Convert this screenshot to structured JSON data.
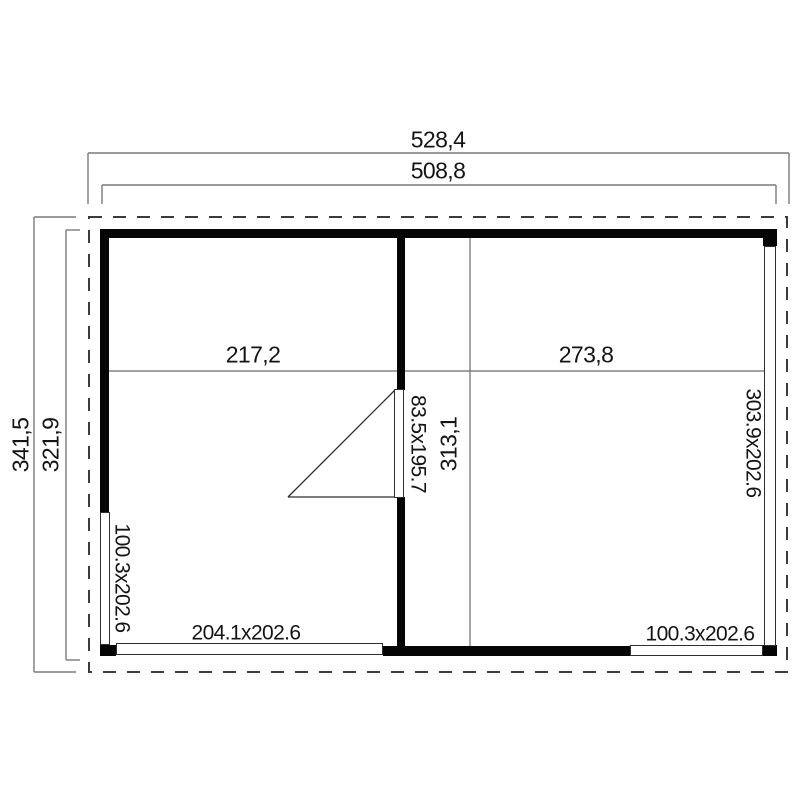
{
  "diagram": {
    "type": "floor-plan",
    "colors": {
      "background": "#ffffff",
      "wall": "#050505",
      "dimension_line": "#7a7a7a",
      "interior_line": "#6b6b6b",
      "roof_outline_dashed": "#3c3c3c",
      "text": "#141414",
      "window_frame": "#2e2e2e"
    },
    "dimensions": {
      "overall_width": "528,4",
      "body_width": "508,8",
      "overall_depth": "341,5",
      "body_depth": "321,9",
      "left_room_width": "217,2",
      "right_room_width": "273,8",
      "right_room_depth": "313,1"
    },
    "openings": {
      "interior_door": "83.5x195.7",
      "right_wall_glazing": "303.9x202.6",
      "left_wall_window": "100.3x202.6",
      "front_left_window": "204.1x202.6",
      "front_right_window": "100.3x202.6"
    }
  }
}
